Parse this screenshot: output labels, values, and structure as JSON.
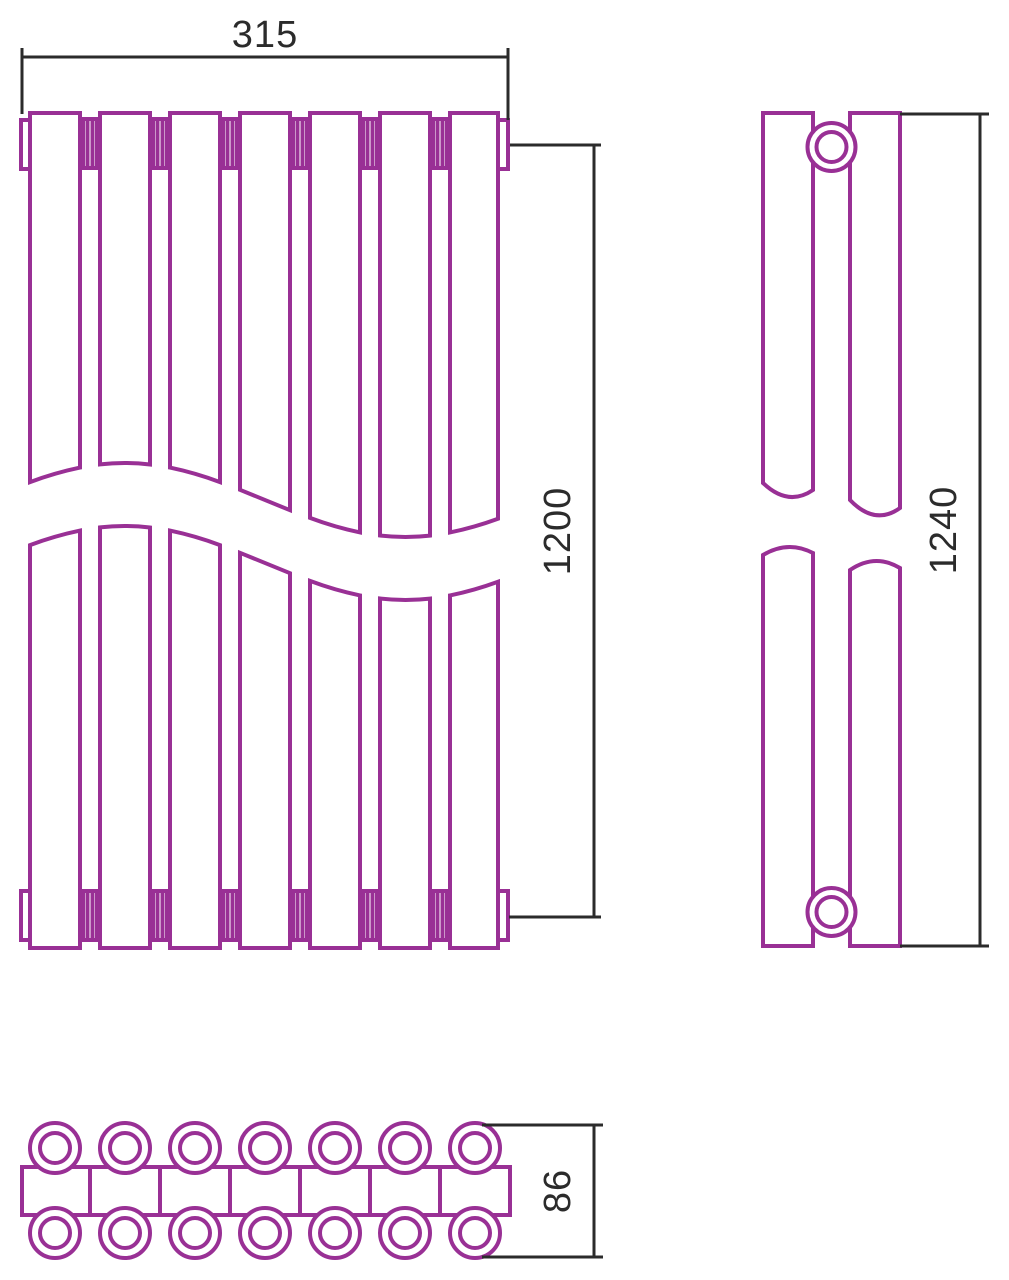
{
  "page": {
    "background": "#ffffff"
  },
  "drawing": {
    "outline_color": "#993095",
    "dimension_color": "#2b2b2b",
    "section_count": 7,
    "views": {
      "front": {
        "label": "front view",
        "dim_width": "315",
        "dim_axis_height": "1200"
      },
      "side": {
        "label": "side view",
        "dim_overall_height": "1240"
      },
      "top": {
        "label": "top view",
        "dim_depth": "86"
      }
    }
  }
}
